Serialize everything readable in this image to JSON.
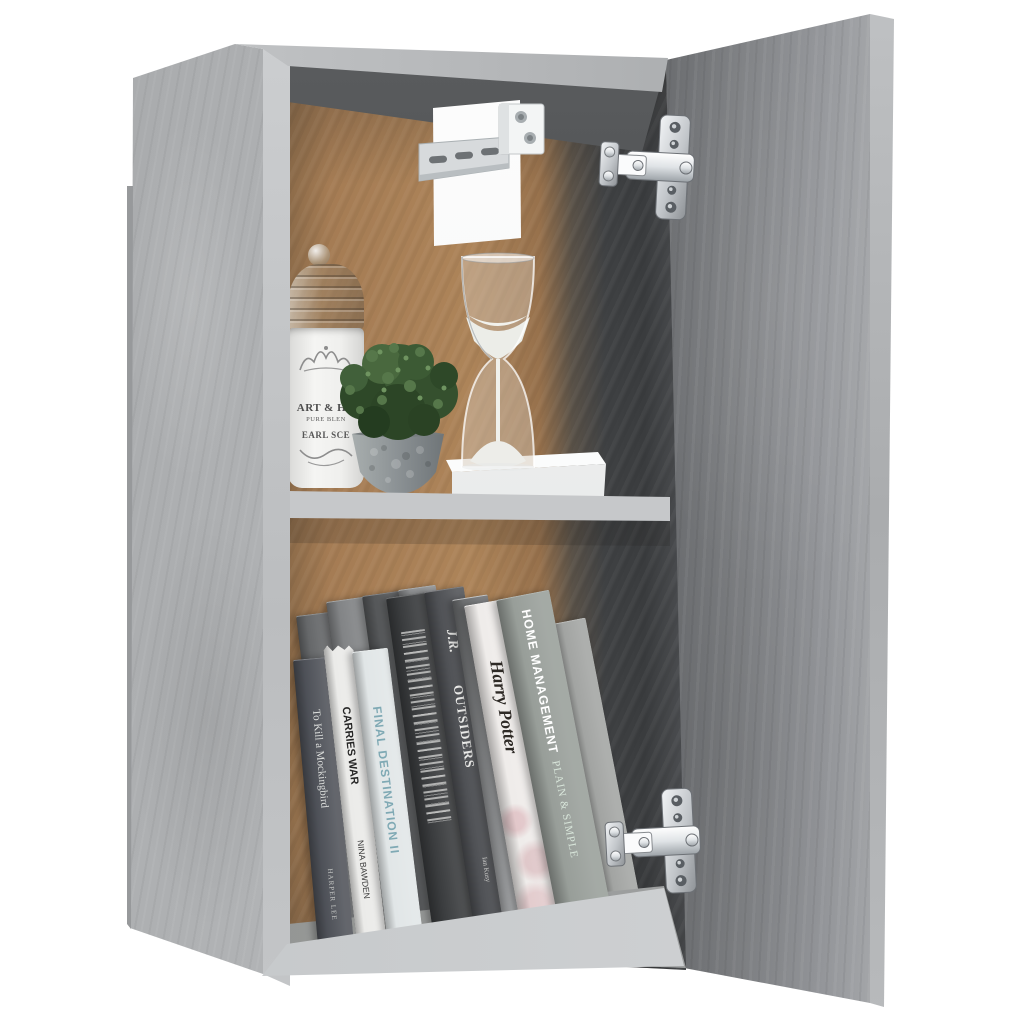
{
  "scene": {
    "subject": "concrete gray wall cabinet with open door",
    "background_color": "#ffffff",
    "colors": {
      "concrete_light": "#b6b8ba",
      "concrete_door": "#8f9193",
      "interior_back_panel": "#a87f58",
      "interior_shadow": "#3c3e40",
      "shelf": "#cfd1d3",
      "metal_chrome": "#d9dcdf",
      "foliage_green": "#44603a",
      "pot_gray": "#8b9194",
      "sand_white": "#f1f1ed"
    },
    "hardware": {
      "hinge_count": 2,
      "wall_bracket_count": 1
    }
  },
  "jar": {
    "label": {
      "line1": "ART & HO",
      "line2": "PURE BLEN",
      "line3": "EARL SCE"
    }
  },
  "books": [
    {
      "title": "To Kill a Mockingbird",
      "author": "HARPER LEE"
    },
    {
      "title": "CARRIES WAR",
      "author": "NINA BAWDEN"
    },
    {
      "title": "FINAL DESTINATION II",
      "author": ""
    },
    {
      "title": "",
      "author": ""
    },
    {
      "monogram": "J.R.",
      "title": "OUTSIDERS",
      "author": "Ian Kusy"
    },
    {
      "author": "ALBERT CAMUS",
      "title": "the OUTSIDER"
    },
    {
      "title": "Harry Potter",
      "author": ""
    },
    {
      "title": "HOME MANAGEMENT",
      "subtitle": "PLAIN & SIMPLE"
    },
    {
      "title": "",
      "author": ""
    }
  ]
}
